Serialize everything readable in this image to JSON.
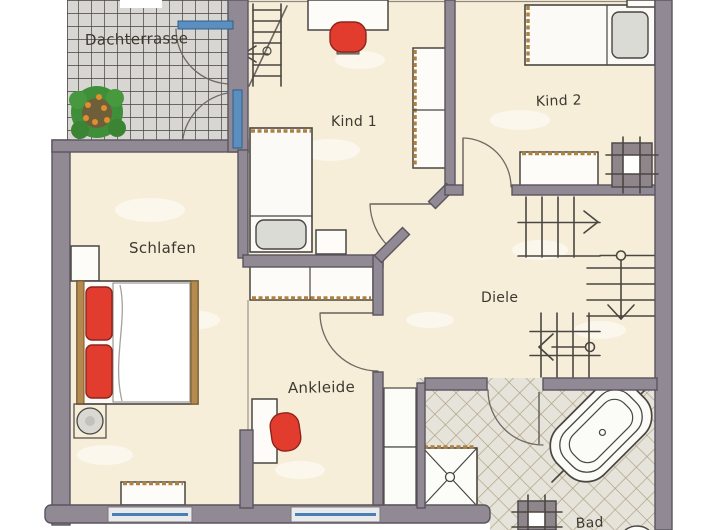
{
  "rooms": {
    "terrace": "Dachterrasse",
    "kind1": "Kind 1",
    "kind2": "Kind 2",
    "schlafen": "Schlafen",
    "diele": "Diele",
    "ankleide": "Ankleide",
    "bad": "Bad"
  },
  "palette": {
    "wall": "#918a94",
    "wall_outline": "#5a545e",
    "floor_cream": "#f7eeda",
    "terrace_tile": "#d7d6d2",
    "terrace_grid": "#45423e",
    "bath_tile": "#e6e3da",
    "bath_grid": "#ab9d80",
    "glass_blue": "#5b8fc0",
    "accent_red": "#e23c2e",
    "wood": "#ad8142",
    "plant_green": "#3f8e3a",
    "ink": "#4a4641"
  }
}
